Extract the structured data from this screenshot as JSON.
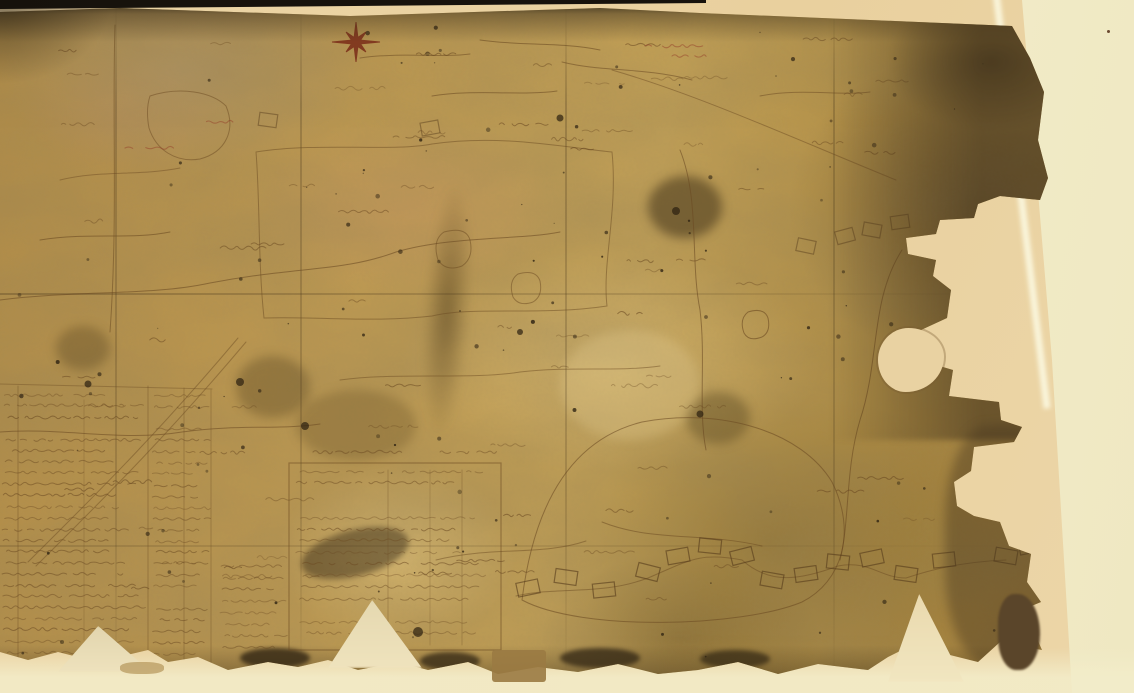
{
  "scene": {
    "type": "photograph",
    "subject": "Early hand-drawn estate map on aged ochre parchment, torn and eroded along its right edge, mounted on a tan backing sheet against a cream backdrop",
    "alt": "Photograph of a heavily aged antique manuscript map with a red eight-pointed compass star near the top, faint brown ink field boundaries and plot outlines, dense illegible survey tables in the lower left, and a jagged torn right edge exposing the cream backing"
  },
  "palette": {
    "backdrop_cream": "#f4eecb",
    "backdrop_cream_bright": "#f8f2d7",
    "backing_tan": "#e9d1a0",
    "map_base": "#b5914b",
    "map_light": "#cdad66",
    "map_dark_olive": "#7d6434",
    "edge_dark_brown": "#4a3920",
    "photo_edge_black": "#17120c",
    "ink_brown": "#6b4a22",
    "ink_dark": "#553a1a",
    "ink_red": "#96402a",
    "compass_red": "#7a2c18",
    "stain_pink": "#c97860",
    "pale_patch": "#e7dab2"
  },
  "compass_rose": {
    "cx": 356,
    "cy": 42,
    "r_ew": 24,
    "r_ns": 20,
    "r_diag": 14,
    "r_inner": 5,
    "color": "#7a2c18"
  },
  "tables": {
    "left": {
      "x": 2,
      "y": 394,
      "width": 142,
      "rows": 24,
      "row_step": 11.2
    },
    "left_col2": {
      "x": 152,
      "y": 395,
      "width": 56,
      "rows": 24,
      "row_step": 11.2
    },
    "left_lower": {
      "x": 220,
      "y": 566,
      "width": 62,
      "rows": 8,
      "row_step": 11.5
    },
    "middle": {
      "x": 295,
      "y": 482,
      "width": 195,
      "rows": 14,
      "row_step": 11.6,
      "border": {
        "x": 289,
        "y": 463,
        "w": 212,
        "h": 187
      }
    }
  },
  "handwriting": {
    "scatter_count": 72,
    "speck_count": 120,
    "red_marks": 4,
    "seed": 20240611
  }
}
